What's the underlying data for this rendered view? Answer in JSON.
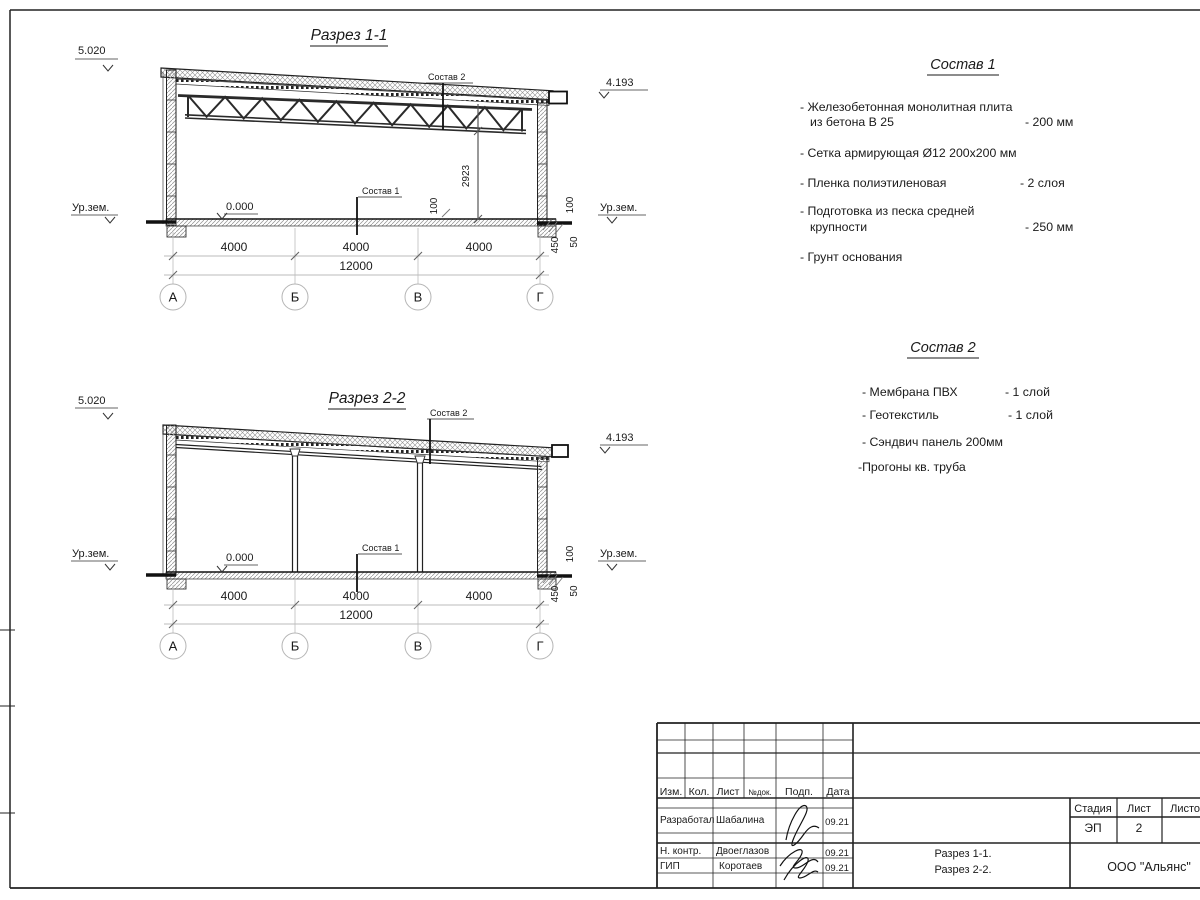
{
  "s1": {
    "title": "Разрез 1-1",
    "elev_left": "5.020",
    "elev_right": "4.193",
    "zero": "0.000",
    "ground_left": "Ур.зем.",
    "ground_right": "Ур.зем.",
    "leader_top": "Состав 2",
    "leader_bottom": "Состав 1",
    "h_dim": "2923",
    "d100a": "100",
    "d100b": "100",
    "d450": "450",
    "d50": "50",
    "dim_a": "4000",
    "dim_b": "4000",
    "dim_c": "4000",
    "dim_total": "12000",
    "ax1": "А",
    "ax2": "Б",
    "ax3": "В",
    "ax4": "Г"
  },
  "s2": {
    "title": "Разрез 2-2",
    "elev_left": "5.020",
    "elev_right": "4.193",
    "zero": "0.000",
    "ground_left": "Ур.зем.",
    "ground_right": "Ур.зем.",
    "leader_top": "Состав 2",
    "leader_bottom": "Состав 1",
    "d100b": "100",
    "d450": "450",
    "d50": "50",
    "dim_a": "4000",
    "dim_b": "4000",
    "dim_c": "4000",
    "dim_total": "12000",
    "ax1": "А",
    "ax2": "Б",
    "ax3": "В",
    "ax4": "Г"
  },
  "c1": {
    "title": "Состав 1",
    "i1a": "- Железобетонная  монолитная плита",
    "i1b": "из бетона В 25",
    "i1v": "- 200 мм",
    "i2": "- Сетка армирующая Ø12 200х200 мм",
    "i3": "- Пленка полиэтиленовая",
    "i3v": "-  2 слоя",
    "i4a": "- Подготовка из песка средней",
    "i4b": "крупности",
    "i4v": "- 250 мм",
    "i5": "- Грунт основания"
  },
  "c2": {
    "title": "Состав 2",
    "i1": "- Мембрана ПВХ",
    "i1v": "- 1 слой",
    "i2": "- Геотекстиль",
    "i2v": "- 1 слой",
    "i3": "- Сэндвич панель 200мм",
    "i4": "-Прогоны кв. труба"
  },
  "tb": {
    "izm": "Изм.",
    "kol": "Кол.",
    "list": "Лист",
    "ndok": "№док.",
    "podp": "Подп.",
    "data": "Дата",
    "r1_role": "Разработал",
    "r1_name": "Шабалина",
    "r1_date": "09.21",
    "r2_role": "Н. контр.",
    "r2_name": "Двоеглазов",
    "r2_date": "09.21",
    "r3_role": "ГИП",
    "r3_name": "Коротаев",
    "r3_date": "09.21",
    "stage_l": "Стадия",
    "sheet_l": "Лист",
    "sheets_l": "Листов",
    "stage": "ЭП",
    "sheet": "2",
    "doc1": "Разрез 1-1.",
    "doc2": "Разрез 2-2.",
    "company": "ООО \"Альянс\""
  }
}
